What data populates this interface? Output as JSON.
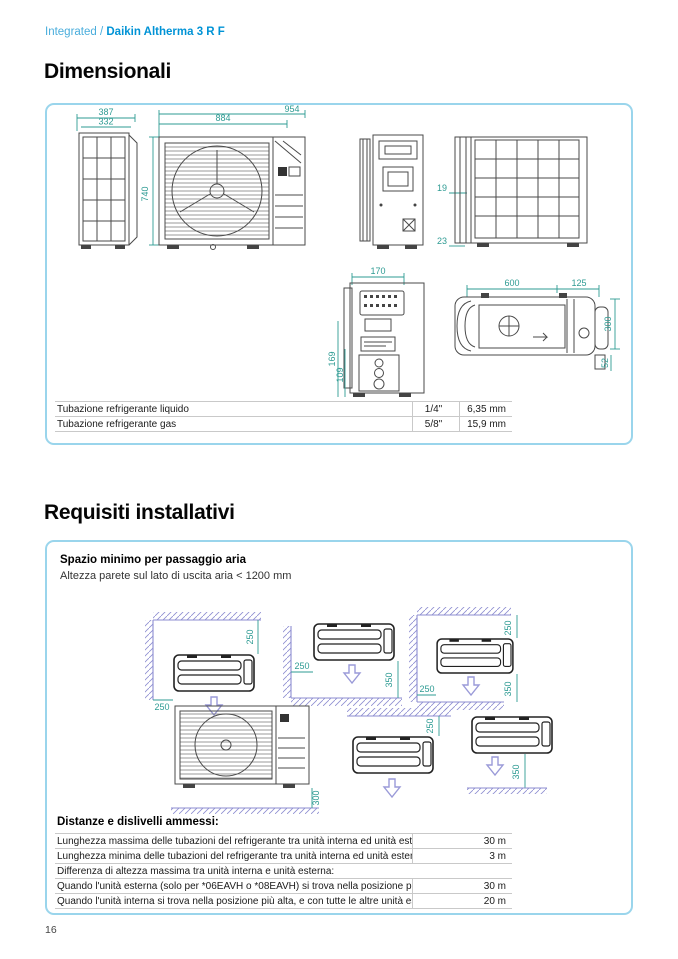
{
  "page": {
    "breadcrumb_prefix": "Integrated / ",
    "breadcrumb_product": "Daikin Altherma 3 R F",
    "page_number": "16"
  },
  "colors": {
    "accent_blue": "#0093d6",
    "breadcrumb_blue": "#49addc",
    "panel_border": "#9ad5ec",
    "dimension_teal": "#2e9b93",
    "wall_hatch_purple": "#8d8dd0"
  },
  "dimensionali": {
    "title": "Dimensionali",
    "drawings": {
      "side_left": {
        "outer_depth": "387",
        "inner_depth": "332"
      },
      "front": {
        "width": "884",
        "total_width": "954",
        "height": "740"
      },
      "back": {
        "gap_top": "19",
        "gap_bottom": "23"
      },
      "back_detail": {
        "top_width": "170",
        "left_outer": "169",
        "left_inner": "109"
      },
      "top_view": {
        "body_length": "600",
        "cap_length": "125",
        "depth": "300",
        "drain": "52"
      }
    },
    "pipe_table": {
      "rows": [
        {
          "label": "Tubazione refrigerante liquido",
          "size": "1/4\"",
          "mm": "6,35 mm"
        },
        {
          "label": "Tubazione refrigerante gas",
          "size": "5/8\"",
          "mm": "15,9 mm"
        }
      ]
    }
  },
  "requisiti": {
    "title": "Requisiti installativi",
    "subtitle_bold": "Spazio minimo per passaggio aria",
    "subtitle": "Altezza parete sul lato di uscita aria < 1200 mm",
    "clearances": {
      "d1_top": "250",
      "d1_left": "250",
      "d2_left": "250",
      "d2_bottom": "350",
      "d3_top": "250",
      "d3_left": "250",
      "d3_bottom": "350",
      "d4_ground": "300",
      "d5_top": "250",
      "d6_bottom": "350"
    },
    "distances": {
      "heading": "Distanze e dislivelli ammessi:",
      "rows": [
        {
          "label": "Lunghezza massima delle tubazioni del refrigerante tra unità interna ed unità esterna",
          "value": "30 m"
        },
        {
          "label": "Lunghezza minima delle tubazioni del refrigerante tra unità interna ed unità esterna",
          "value": "3 m"
        },
        {
          "label": "Differenza di altezza massima tra unità interna e unità esterna:",
          "value": ""
        },
        {
          "label": "Quando l'unità esterna (solo per *06EAVH o *08EAVH) si trova nella posizione più alta",
          "value": "30 m"
        },
        {
          "label": "Quando l'unità interna si trova nella posizione più alta, e con tutte le altre unità esterne",
          "value": "20 m"
        }
      ]
    }
  }
}
